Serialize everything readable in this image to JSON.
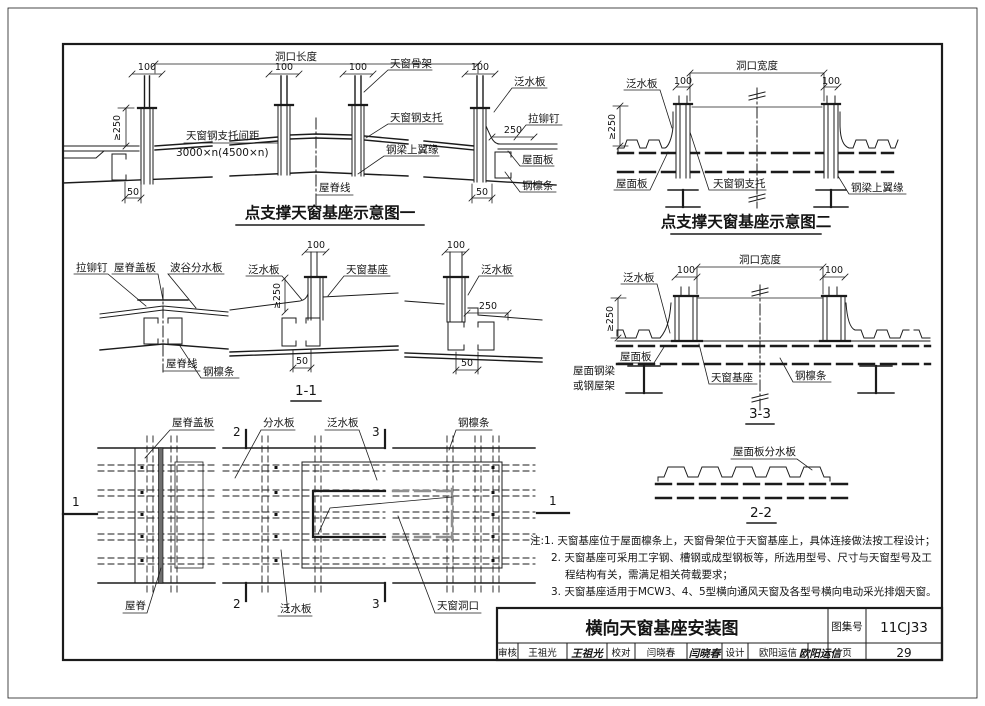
{
  "labels": {
    "opening_length": "洞口长度",
    "opening_width": "洞口宽度",
    "d100": "100",
    "d250": "250",
    "d50": "50",
    "ge250": "≥250",
    "skylight_frame": "天窗骨架",
    "steel_support": "天窗钢支托",
    "support_spacing": "天窗钢支托间距",
    "spacing_value": "3000×n(4500×n)",
    "beam_top_flange": "钢梁上翼缘",
    "flashing": "泛水板",
    "rivet": "拉铆钉",
    "roof_panel": "屋面板",
    "purlin": "钢檩条",
    "ridge_line": "屋脊线",
    "ridge_cover": "屋脊盖板",
    "trough_divider": "波谷分水板",
    "skylight_base": "天窗基座",
    "divider": "分水板",
    "ridge": "屋脊",
    "skylight_opening": "天窗洞口",
    "roof_beam_l1": "屋面钢梁",
    "roof_beam_l2": "或钢屋架",
    "roof_panel_divider": "屋面板分水板",
    "m1": "1",
    "m2": "2",
    "m3": "3"
  },
  "fig1": {
    "title": "点支撑天窗基座示意图一"
  },
  "fig2": {
    "title": "点支撑天窗基座示意图二"
  },
  "sections": {
    "s11": "1-1",
    "s22": "2-2",
    "s33": "3-3"
  },
  "notes": {
    "n1": "注:1. 天窗基座位于屋面檩条上，天窗骨架位于天窗基座上，具体连接做法按工程设计；",
    "n2": "2. 天窗基座可采用工字钢、槽钢或成型钢板等，所选用型号、尺寸与天窗型号及工",
    "n3": "程结构有关，需满足相关荷载要求；",
    "n4": "3. 天窗基座适用于MCW3、4、5型横向通风天窗及各型号横向电动采光排烟天窗。"
  },
  "titleblock": {
    "drawing_title": "横向天窗基座安装图",
    "atlas_label": "图集号",
    "atlas_no": "11CJ33",
    "page_label": "页",
    "page_no": "29",
    "review_label": "审核",
    "reviewer": "王祖光",
    "reviewer_sig": "王祖光",
    "proof_label": "校对",
    "proofreader": "闫晓春",
    "proofreader_sig": "闫晓春",
    "design_label": "设计",
    "designer": "欧阳运信",
    "designer_sig": "欧阳运信"
  }
}
